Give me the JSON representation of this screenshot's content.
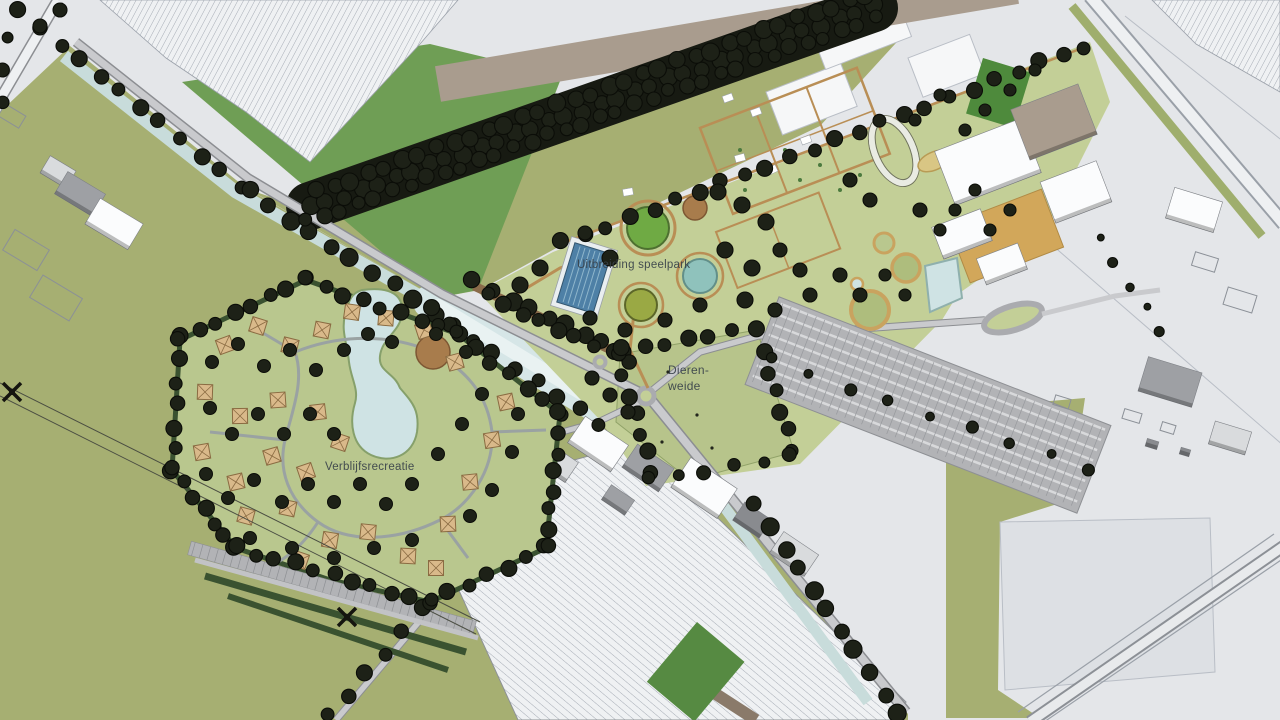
{
  "map": {
    "title": "Landscape development site plan",
    "labels": {
      "speelpark": "Uitbreiding speelpark",
      "dierenweide_line1": "Dieren-",
      "dierenweide_line2": "weide",
      "verblijfsrecreatie": "Verblijfsrecreatie"
    },
    "palette": {
      "base": "#e4e6e9",
      "olive": "#a6af72",
      "parkGreen": "#c3cf97",
      "meadowGreen": "#b7c48b",
      "bungalowGreen": "#b9c78e",
      "midGreen": "#6f9e55",
      "darkGreenField": "#568a42",
      "darkGreenRect": "#4e8a3c",
      "tree": "#1d2117",
      "treeEdge": "#0b0d08",
      "hedge": "#3a5230",
      "water": "#c8dcdb",
      "waterWide": "#d6e6e7",
      "waterLight": "#e9f2f2",
      "pondBlue": "#cfe3e4",
      "poolBlue": "#4e80a6",
      "poolLane": "#8fb6cc",
      "tealPond": "#8fc2bc",
      "greenCircle": "#6faa44",
      "oliveCircle": "#9aa944",
      "road": "#aaabaf",
      "roadInner": "#c9cacd",
      "roadCasing": "#8c8e92",
      "roadLight": "#eef0f2",
      "taupe": "#a99c8e",
      "hatchBg": "#eff1f3",
      "hatchLine": "#a6acb5",
      "parking": "#b2b3b6",
      "parkingLine": "#d8d9db",
      "path": "#b98e55",
      "dike": "#8a6b4a",
      "chalet": "#d9b98a",
      "chaletEdge": "#8a6b42",
      "plaza": "#a87c4c",
      "building": "#fbfcfd",
      "buildingGray": "#9ea0a4",
      "buildingMid": "#d9dbdd",
      "buildingDark": "#898b8f",
      "buildingShadow": "#8f9195",
      "ochre": "#d2a75a",
      "sand": "#d9c684",
      "fieldWhite": "#dde0e4",
      "outline": "#b9bec6",
      "pylon": "#15150f",
      "label": "#39424a"
    }
  }
}
